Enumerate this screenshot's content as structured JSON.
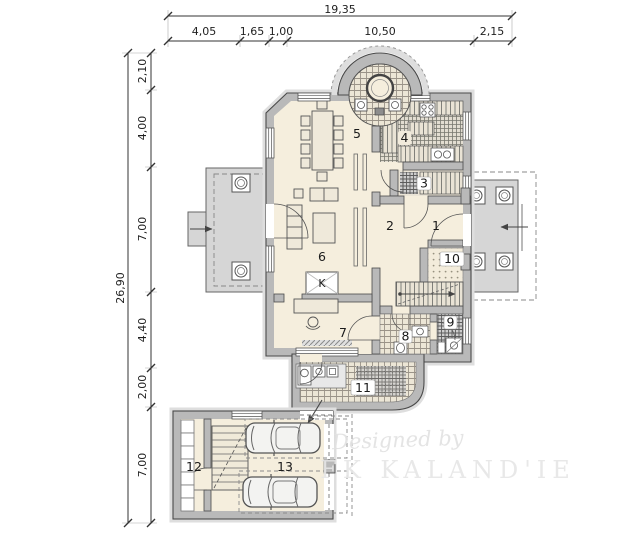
{
  "drawing": {
    "type": "architectural floor plan, ground storey with garage"
  },
  "dimensions": {
    "top": {
      "total": "19,35",
      "segments": [
        "4,05",
        "1,65",
        "1,00",
        "10,50",
        "2,15"
      ]
    },
    "left": {
      "total": "26,90",
      "segments": [
        "2,10",
        "4,00",
        "7,00",
        "4,40",
        "2,00",
        "7,00"
      ]
    }
  },
  "rooms": [
    "1",
    "2",
    "3",
    "4",
    "5",
    "6",
    "7",
    "8",
    "9",
    "10",
    "11",
    "12",
    "13"
  ],
  "fireplace": "K",
  "watermark": {
    "line1": "Designed by",
    "line2": "FK KALAND'IE"
  },
  "colors": {
    "wall": "#b9b9b9",
    "floor": "#f5eedd",
    "terrace": "#d6d6d6",
    "outline": "#4a4a4a",
    "dimension_text": "#1f1f1f",
    "watermark": "#e4e4e4"
  }
}
